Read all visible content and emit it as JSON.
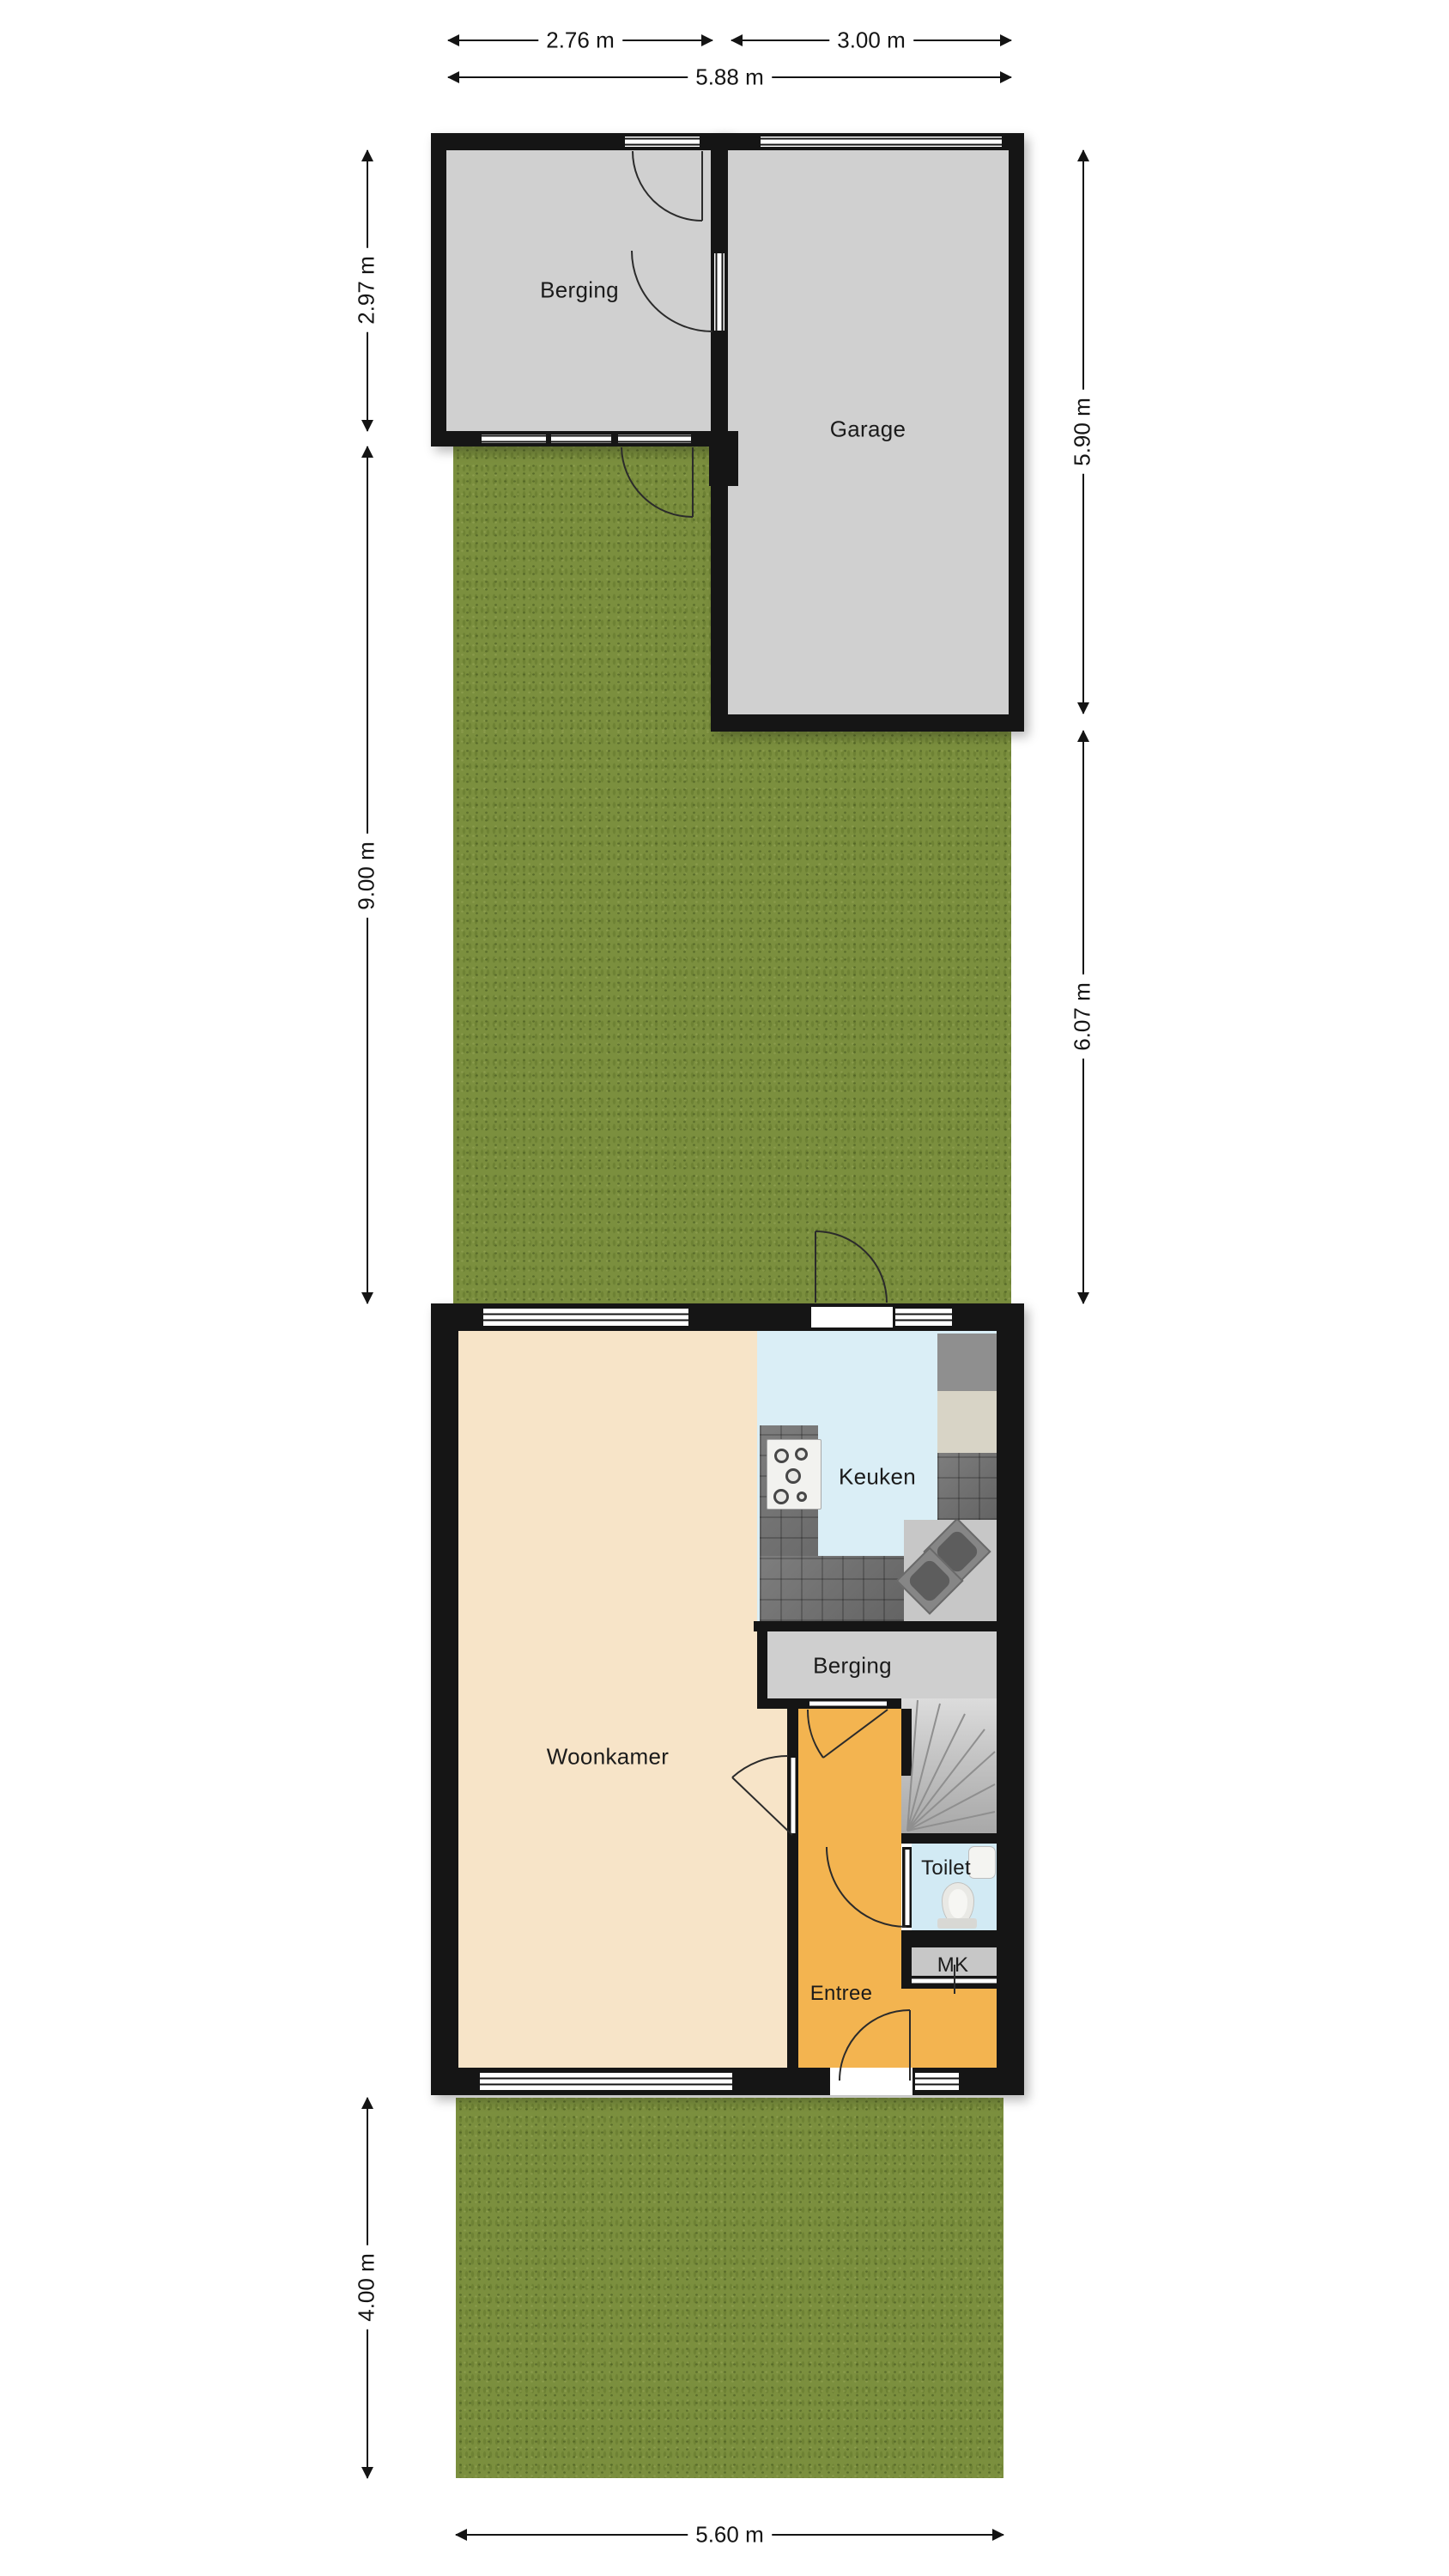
{
  "plan": {
    "rooms": {
      "berging_top": "Berging",
      "garage": "Garage",
      "keuken": "Keuken",
      "woonkamer": "Woonkamer",
      "berging": "Berging",
      "toilet": "Toilet",
      "mk": "MK",
      "entree": "Entree"
    },
    "dimensions": {
      "top_left": "2.76 m",
      "top_right": "3.00 m",
      "top_total": "5.88 m",
      "left_top": "2.97 m",
      "left_middle": "9.00 m",
      "left_bottom": "4.00 m",
      "right_top": "5.90 m",
      "right_bottom": "6.07 m",
      "bottom_total": "5.60 m"
    },
    "colors": {
      "wall": "#151515",
      "garden": "#7b8f3e",
      "outbuilding_floor": "#d0d0d0",
      "woonkamer_floor": "#f7e4c8",
      "keuken_floor": "#daeef6",
      "toilet_floor": "#d2eaf4",
      "entree_floor": "#f3b450",
      "berging_floor": "#cfcfcf",
      "counter": "#6f6f6f",
      "stairs": "#c6c6c6"
    }
  }
}
